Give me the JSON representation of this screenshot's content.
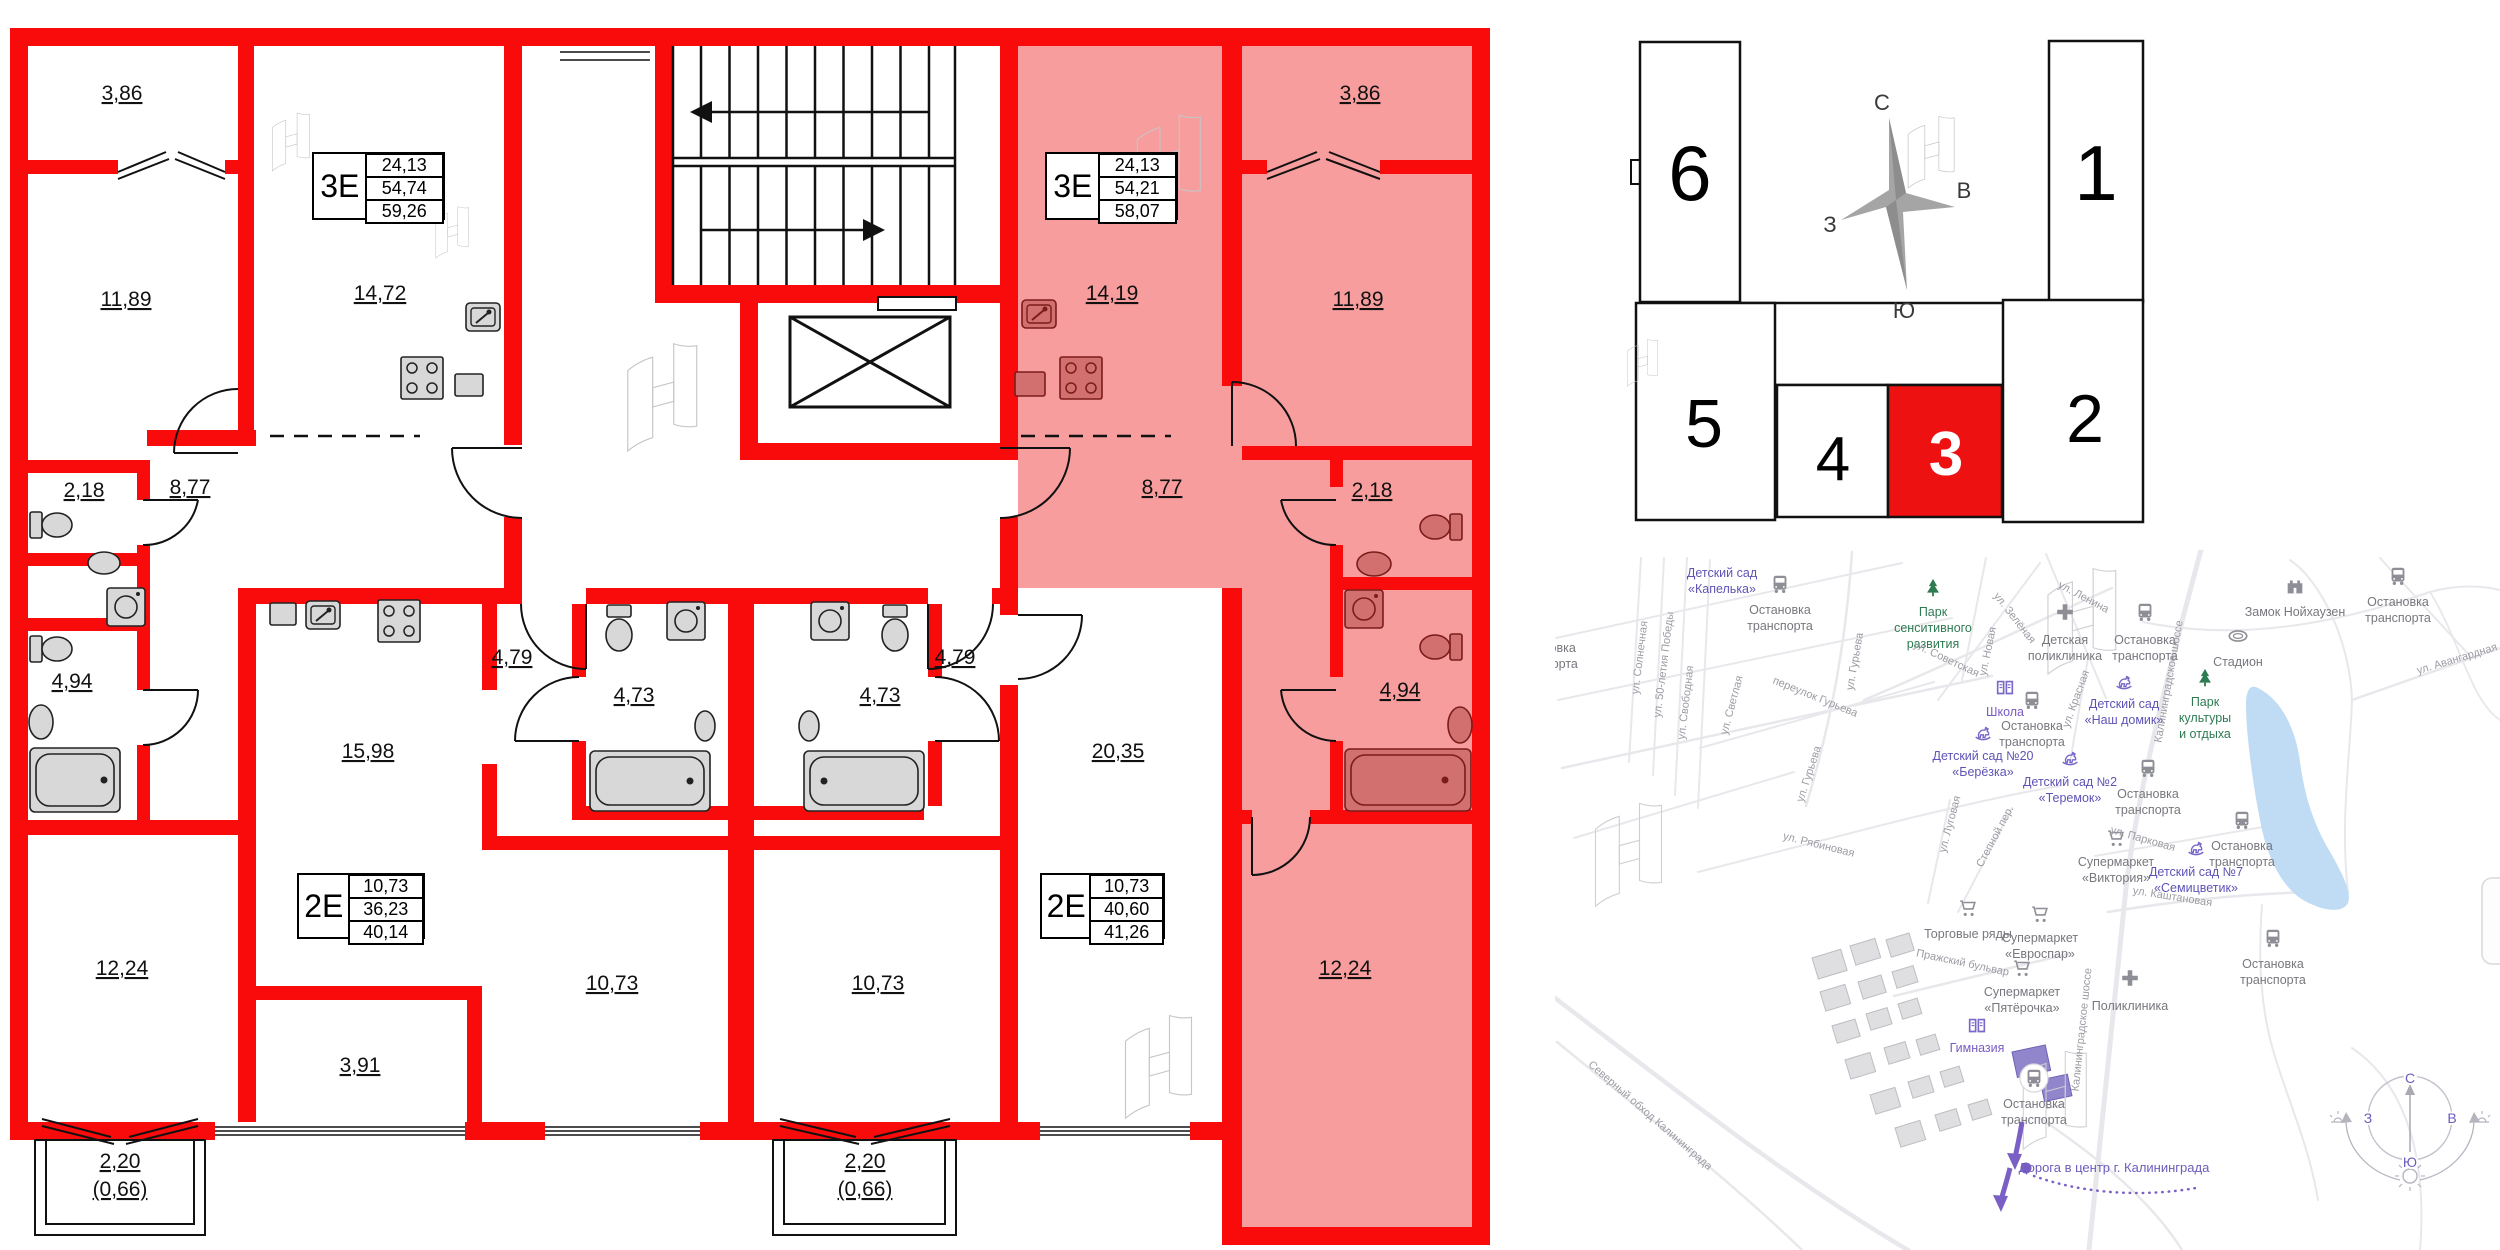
{
  "floor_plan": {
    "tables": [
      {
        "id": "left-3e",
        "type": "3Е",
        "values": [
          "24,13",
          "54,74",
          "59,26"
        ],
        "x": 312,
        "y": 152,
        "w": 133,
        "h": 68
      },
      {
        "id": "right-3e",
        "type": "3Е",
        "values": [
          "24,13",
          "54,21",
          "58,07"
        ],
        "x": 1045,
        "y": 152,
        "w": 133,
        "h": 68
      },
      {
        "id": "left-2e",
        "type": "2Е",
        "values": [
          "10,73",
          "36,23",
          "40,14"
        ],
        "x": 297,
        "y": 873,
        "w": 128,
        "h": 66
      },
      {
        "id": "right-2e",
        "type": "2Е",
        "values": [
          "10,73",
          "40,60",
          "41,26"
        ],
        "x": 1040,
        "y": 873,
        "w": 125,
        "h": 66
      }
    ],
    "rooms": [
      {
        "t": "3,86",
        "x": 122,
        "y": 100
      },
      {
        "t": "11,89",
        "x": 126,
        "y": 306
      },
      {
        "t": "14,72",
        "x": 380,
        "y": 300
      },
      {
        "t": "8,77",
        "x": 190,
        "y": 494
      },
      {
        "t": "2,18",
        "x": 84,
        "y": 497
      },
      {
        "t": "4,94",
        "x": 72,
        "y": 688
      },
      {
        "t": "12,24",
        "x": 122,
        "y": 975
      },
      {
        "t": "3,91",
        "x": 360,
        "y": 1072
      },
      {
        "t": "2,20",
        "x": 120,
        "y": 1168
      },
      {
        "t": "(0,66)",
        "x": 120,
        "y": 1196
      },
      {
        "t": "15,98",
        "x": 368,
        "y": 758
      },
      {
        "t": "4,79",
        "x": 512,
        "y": 664
      },
      {
        "t": "4,73",
        "x": 634,
        "y": 702
      },
      {
        "t": "10,73",
        "x": 612,
        "y": 990
      },
      {
        "t": "4,73",
        "x": 880,
        "y": 702
      },
      {
        "t": "4,79",
        "x": 955,
        "y": 664
      },
      {
        "t": "20,35",
        "x": 1118,
        "y": 758
      },
      {
        "t": "10,73",
        "x": 878,
        "y": 990
      },
      {
        "t": "2,20",
        "x": 865,
        "y": 1168
      },
      {
        "t": "(0,66)",
        "x": 865,
        "y": 1196
      },
      {
        "t": "3,86",
        "x": 1360,
        "y": 100
      },
      {
        "t": "14,19",
        "x": 1112,
        "y": 300
      },
      {
        "t": "11,89",
        "x": 1358,
        "y": 306
      },
      {
        "t": "8,77",
        "x": 1162,
        "y": 494
      },
      {
        "t": "2,18",
        "x": 1372,
        "y": 497
      },
      {
        "t": "4,94",
        "x": 1400,
        "y": 697
      },
      {
        "t": "12,24",
        "x": 1345,
        "y": 975
      }
    ]
  },
  "building_scheme": {
    "sections": [
      {
        "n": "6",
        "x": 1640,
        "y": 42,
        "w": 100,
        "h": 260,
        "tx": 1690,
        "ty": 200,
        "fs": 78,
        "hl": false
      },
      {
        "n": "1",
        "x": 2049,
        "y": 41,
        "w": 94,
        "h": 261,
        "tx": 2096,
        "ty": 200,
        "fs": 78,
        "hl": false
      },
      {
        "n": "5",
        "x": 1636,
        "y": 303,
        "w": 139,
        "h": 217,
        "tx": 1704,
        "ty": 447,
        "fs": 68,
        "hl": false
      },
      {
        "n": "4",
        "x": 1777,
        "y": 385,
        "w": 111,
        "h": 132,
        "tx": 1833,
        "ty": 480,
        "fs": 62,
        "hl": false
      },
      {
        "n": "3",
        "x": 1888,
        "y": 385,
        "w": 114,
        "h": 132,
        "tx": 1946,
        "ty": 475,
        "fs": 62,
        "hl": true
      },
      {
        "n": "2",
        "x": 2003,
        "y": 300,
        "w": 140,
        "h": 222,
        "tx": 2085,
        "ty": 442,
        "fs": 68,
        "hl": false
      }
    ],
    "compass": {
      "n": "С",
      "s": "Ю",
      "w": "З",
      "e": "В"
    }
  },
  "map": {
    "pois": [
      {
        "icon": "bus",
        "x": 1780,
        "y": 584,
        "c": "gray",
        "lines": [
          "Остановка",
          "транспорта"
        ],
        "ly": 614
      },
      {
        "icon": "bus",
        "x": 2398,
        "y": 576,
        "c": "gray",
        "lines": [
          "Остановка",
          "транспорта"
        ],
        "ly": 606
      },
      {
        "icon": "bus",
        "x": 2145,
        "y": 612,
        "c": "gray",
        "lines": [
          "Остановка",
          "транспорта"
        ],
        "ly": 644
      },
      {
        "icon": "bus",
        "x": 1545,
        "y": 622,
        "c": "gray",
        "lines": [
          "Остановка",
          "транспорта"
        ],
        "ly": 652
      },
      {
        "icon": "bus",
        "x": 2032,
        "y": 700,
        "c": "gray",
        "lines": [
          "Остановка",
          "транспорта"
        ],
        "ly": 730
      },
      {
        "icon": "bus",
        "x": 2148,
        "y": 768,
        "c": "gray",
        "lines": [
          "Остановка",
          "транспорта"
        ],
        "ly": 798
      },
      {
        "icon": "bus",
        "x": 2242,
        "y": 820,
        "c": "gray",
        "lines": [
          "Остановка",
          "транспорта"
        ],
        "ly": 850
      },
      {
        "icon": "bus",
        "x": 2273,
        "y": 938,
        "c": "gray",
        "lines": [
          "Остановка",
          "транспорта"
        ],
        "ly": 968
      },
      {
        "icon": "bus",
        "x": 2034,
        "y": 1078,
        "c": "gray",
        "bg": true,
        "lines": [
          "Остановка",
          "транспорта"
        ],
        "ly": 1108
      },
      {
        "icon": "cross",
        "x": 2065,
        "y": 612,
        "c": "gray",
        "lines": [
          "Детская",
          "поликлиника"
        ],
        "ly": 644
      },
      {
        "icon": "cross",
        "x": 2130,
        "y": 978,
        "c": "gray",
        "lines": [
          "Поликлиника"
        ],
        "ly": 1010
      },
      {
        "icon": "book",
        "x": 2005,
        "y": 688,
        "c": "school",
        "lines": [
          "Школа"
        ],
        "ly": 716
      },
      {
        "icon": "book",
        "x": 1977,
        "y": 1026,
        "c": "school",
        "lines": [
          "Гимназия"
        ],
        "ly": 1052
      },
      {
        "icon": "horse",
        "x": 1983,
        "y": 733,
        "c": "kid",
        "lines": [
          "Детский сад №20",
          "«Берёзка»"
        ],
        "ly": 760
      },
      {
        "icon": "none",
        "x": 1722,
        "y": 540,
        "c": "kid",
        "lines": [
          "Детский сад",
          "«Капелька»"
        ],
        "ly": 577
      },
      {
        "icon": "tree",
        "x": 1933,
        "y": 588,
        "c": "green",
        "lines": [
          "Парк",
          "сенситивного",
          "развития"
        ],
        "ly": 616
      },
      {
        "icon": "tree",
        "x": 2205,
        "y": 678,
        "c": "green",
        "lines": [
          "Парк",
          "культуры",
          "и отдыха"
        ],
        "ly": 706
      },
      {
        "icon": "horse",
        "x": 2124,
        "y": 682,
        "c": "kid",
        "lines": [
          "Детский сад",
          "«Наш домик»"
        ],
        "ly": 708
      },
      {
        "icon": "horse",
        "x": 2070,
        "y": 758,
        "c": "kid",
        "lines": [
          "Детский сад №2",
          "«Теремок»"
        ],
        "ly": 786
      },
      {
        "icon": "horse",
        "x": 2196,
        "y": 848,
        "c": "kid",
        "lines": [
          "Детский сад №7",
          "«Семицветик»"
        ],
        "ly": 876
      },
      {
        "icon": "castle",
        "x": 2295,
        "y": 586,
        "c": "gray",
        "lines": [
          "Замок Нойхаузен"
        ],
        "ly": 616
      },
      {
        "icon": "stadium",
        "x": 2238,
        "y": 636,
        "c": "gray",
        "lines": [
          "Стадион"
        ],
        "ly": 666
      },
      {
        "icon": "cart",
        "x": 2116,
        "y": 838,
        "c": "gray",
        "lines": [
          "Супермаркет",
          "«Виктория»"
        ],
        "ly": 866
      },
      {
        "icon": "cart",
        "x": 2040,
        "y": 914,
        "c": "gray",
        "lines": [
          "Супермаркет",
          "«Евроспар»"
        ],
        "ly": 942
      },
      {
        "icon": "cart",
        "x": 1968,
        "y": 908,
        "c": "gray",
        "lines": [
          "Торговые ряды"
        ],
        "ly": 938
      },
      {
        "icon": "cart",
        "x": 2022,
        "y": 968,
        "c": "gray",
        "lines": [
          "Супермаркет",
          "«Пятёрочка»"
        ],
        "ly": 996
      }
    ],
    "streets": [
      {
        "t": "ул. Солнечная",
        "x": 1643,
        "y": 658,
        "r": -83
      },
      {
        "t": "ул. 50-летия Победы",
        "x": 1667,
        "y": 665,
        "r": -83
      },
      {
        "t": "ул. Свободная",
        "x": 1689,
        "y": 703,
        "r": -83
      },
      {
        "t": "ул. Светлая",
        "x": 1735,
        "y": 706,
        "r": -75
      },
      {
        "t": "переулок Гурьева",
        "x": 1814,
        "y": 700,
        "r": 22
      },
      {
        "t": "ул. Гурьева",
        "x": 1858,
        "y": 662,
        "r": -80
      },
      {
        "t": "ул. Гурьева",
        "x": 1812,
        "y": 775,
        "r": -72
      },
      {
        "t": "ул. Советская",
        "x": 1945,
        "y": 662,
        "r": 25
      },
      {
        "t": "ул. Зелёная",
        "x": 2012,
        "y": 620,
        "r": 52
      },
      {
        "t": "ул. Новая",
        "x": 1991,
        "y": 652,
        "r": -78
      },
      {
        "t": "ул. Ленина",
        "x": 2082,
        "y": 600,
        "r": 28
      },
      {
        "t": "ул. Красная",
        "x": 2079,
        "y": 700,
        "r": -70
      },
      {
        "t": "Калининградское шоссе",
        "x": 2172,
        "y": 682,
        "r": -80
      },
      {
        "t": "Калининградское шоссе",
        "x": 2085,
        "y": 1030,
        "r": -84
      },
      {
        "t": "ул. Авангардная",
        "x": 2458,
        "y": 662,
        "r": -17
      },
      {
        "t": "ул. Рябиновая",
        "x": 1818,
        "y": 848,
        "r": 14
      },
      {
        "t": "ул. Луговая",
        "x": 1953,
        "y": 825,
        "r": -75
      },
      {
        "t": "Степной пер.",
        "x": 1998,
        "y": 838,
        "r": -62
      },
      {
        "t": "Пражский бульвар",
        "x": 1962,
        "y": 966,
        "r": 12
      },
      {
        "t": "ул. Парковая",
        "x": 2142,
        "y": 842,
        "r": 16
      },
      {
        "t": "ул. Каштановая",
        "x": 2172,
        "y": 900,
        "r": 9
      },
      {
        "t": "Северный обход Калининграда",
        "x": 1648,
        "y": 1118,
        "r": 41
      }
    ],
    "route": {
      "label": "Дорога в центр г. Калининграда"
    },
    "sun_compass": {
      "n": "С",
      "s": "Ю",
      "w": "З",
      "e": "В"
    }
  },
  "colors": {
    "wall_red": "#f90b0b",
    "apartment_fill": "#f79d9d",
    "pink_fixture": "#d2706f",
    "scheme_highlight": "#ee1111",
    "map_purple": "#7a5fc4",
    "map_green": "#2e7b52",
    "water": "#bfdcf4"
  }
}
